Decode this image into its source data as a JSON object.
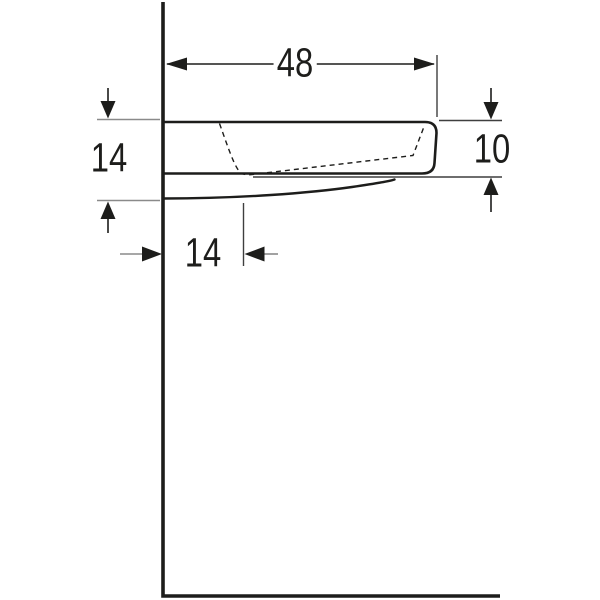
{
  "drawing": {
    "labels": {
      "width_top": "48",
      "height_left": "14",
      "height_right": "10",
      "depth_bottom": "14"
    },
    "colors": {
      "line": "#1d1d1b",
      "extension": "#8a8a8a",
      "thin": "#3f3f3f",
      "background": "#ffffff",
      "text": "#1d1d1b"
    }
  }
}
